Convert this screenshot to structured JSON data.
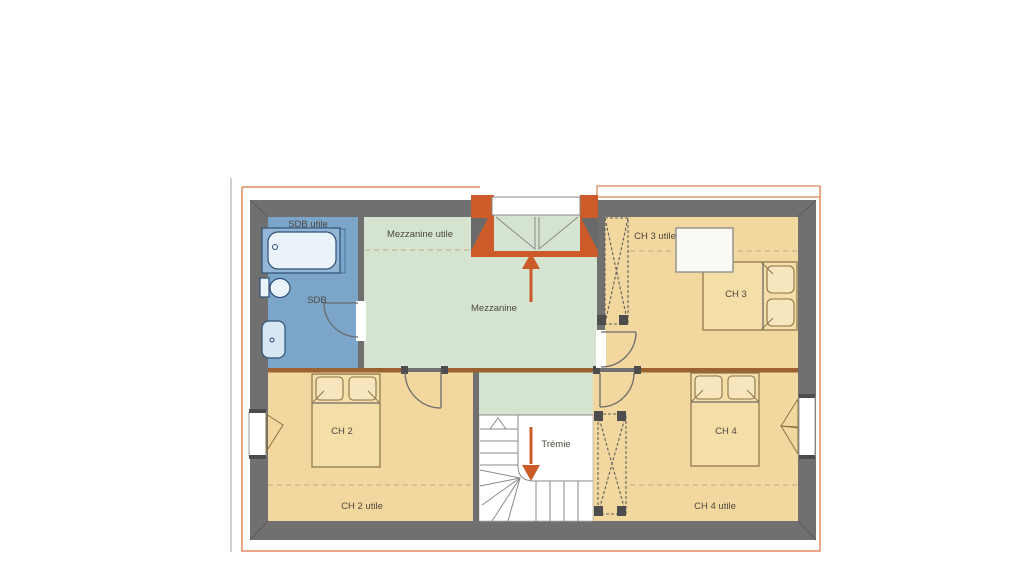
{
  "plan": {
    "type": "floor-plan",
    "floor": "upper-floor",
    "rooms": {
      "sdb": {
        "name": "SDB",
        "utile": "SDB utile"
      },
      "mezzanine": {
        "name": "Mezzanine",
        "utile": "Mezzanine utile"
      },
      "ch2": {
        "name": "CH 2",
        "utile": "CH 2 utile"
      },
      "ch3": {
        "name": "CH 3",
        "utile": "CH 3 utile"
      },
      "ch4": {
        "name": "CH 4",
        "utile": "CH 4 utile"
      }
    },
    "stairwell": {
      "name": "Trémie"
    },
    "arrows": {
      "entry_direction": "up",
      "tremie_direction": "down"
    }
  },
  "colors": {
    "wall_gray": "#707070",
    "bedroom_tan": "#f2d79f",
    "mezzanine_green": "#d4e4d0",
    "bathroom_blue": "#7ba6ca",
    "accent_orange": "#cc5b29",
    "mid_wall_brown": "#9a6331",
    "roof_outline_salmon": "#e08a5e",
    "utile_dash": "#c8b694",
    "label_text": "#4d473e"
  },
  "icons": {
    "bathtub-icon": "rounded-tub-shape",
    "toilet-icon": "tank-and-bowl-shape",
    "washbasin-icon": "rounded-basin-shape",
    "double-bed-icon": "bed-with-two-pillows",
    "wardrobe-icon": "dashed-box-with-x",
    "stairs-icon": "l-shaped-winder-stairs",
    "door-swing-icon": "quarter-circle-arc",
    "window-icon": "casement-swing-triangles",
    "arrow-up-icon": "orange-up-arrow",
    "arrow-down-icon": "orange-down-arrow"
  }
}
